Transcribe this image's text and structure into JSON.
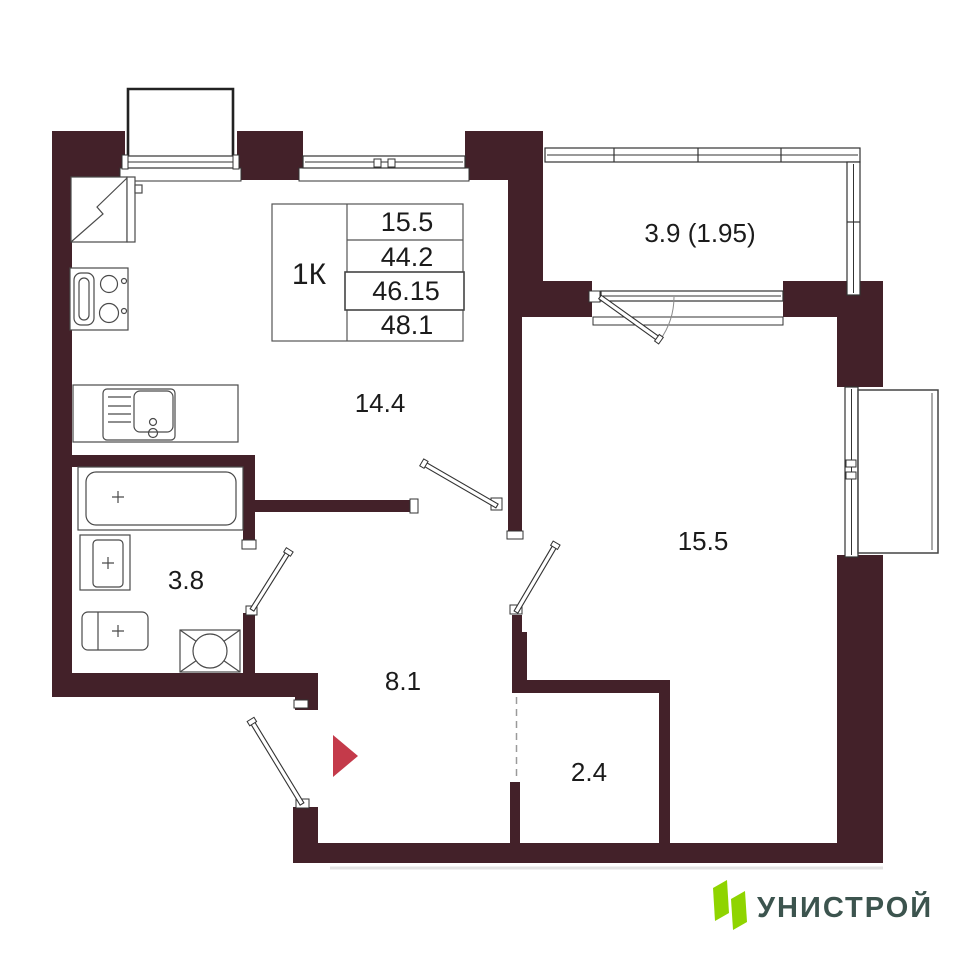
{
  "plan": {
    "rooms": [
      {
        "name": "kitchen-living",
        "area": "14.4"
      },
      {
        "name": "living-room",
        "area": "15.5"
      },
      {
        "name": "hallway",
        "area": "8.1"
      },
      {
        "name": "bathroom",
        "area": "3.8"
      },
      {
        "name": "wardrobe",
        "area": "2.4"
      },
      {
        "name": "balcony",
        "area": "3.9 (1.95)"
      }
    ],
    "info_table": {
      "type": "1К",
      "values": [
        "15.5",
        "44.2",
        "46.15",
        "48.1"
      ]
    }
  },
  "logo": {
    "brand": "УНИСТРОЙ"
  },
  "colors": {
    "wall": "#432129",
    "arrow_red": "#C43A4A",
    "logo_green": "#8FD400",
    "logo_text": "#3C544E"
  }
}
